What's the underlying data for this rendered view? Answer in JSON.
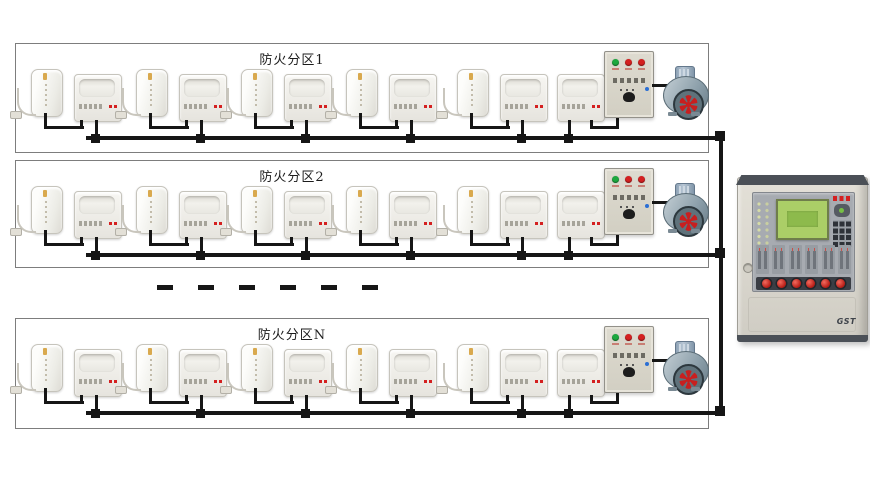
{
  "zones": [
    {
      "label": "防火分区1"
    },
    {
      "label": "防火分区2"
    },
    {
      "label": "防火分区N"
    }
  ],
  "panel": {
    "brand_logo": "GST"
  },
  "icons": {
    "fan_blades": "fan-blades-icon",
    "cord": "cord-icon",
    "plug": "plug-icon"
  },
  "colors": {
    "wire": "#161616",
    "led_green": "#1da83f",
    "led_red": "#d42020",
    "fan_red": "#c81f1f",
    "lcd_green": "#abce67",
    "panel_inner": "#a7abb1",
    "panel_dark": "#4b5057",
    "blue_dot": "#2b6fd4"
  }
}
